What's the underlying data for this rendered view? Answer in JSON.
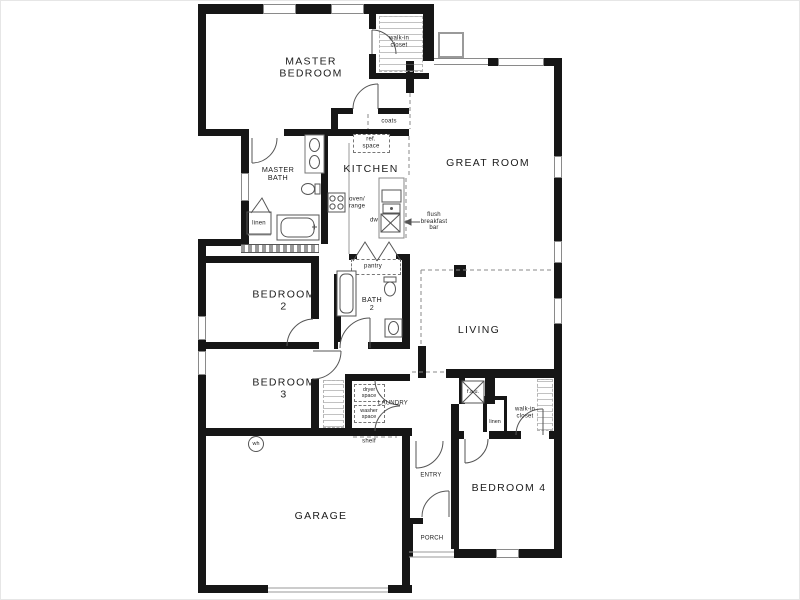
{
  "title": "Single-story house floor plan",
  "colors": {
    "wall": "#161616",
    "line": "#8a8a8a",
    "background": "#ffffff"
  },
  "labels": {
    "master_bedroom": [
      "MASTER",
      "BEDROOM"
    ],
    "walk_in_closet_master": [
      "walk-in",
      "closet"
    ],
    "coats": [
      "coats"
    ],
    "master_bath": [
      "MASTER",
      "BATH"
    ],
    "linen_master": [
      "linen"
    ],
    "ref_space": [
      "ref.",
      "space"
    ],
    "kitchen": [
      "KITCHEN"
    ],
    "oven_range": [
      "oven/",
      "range"
    ],
    "dishwasher": [
      "dw"
    ],
    "flush_breakfast_bar": [
      "flush",
      "breakfast",
      "bar"
    ],
    "great_room": [
      "GREAT ROOM"
    ],
    "pantry": [
      "pantry"
    ],
    "bedroom_2": [
      "BEDROOM",
      "2"
    ],
    "bath_2": [
      "BATH",
      "2"
    ],
    "bedroom_3": [
      "BEDROOM",
      "3"
    ],
    "dryer_space": [
      "dryer",
      "space"
    ],
    "laundry": [
      "LAUNDRY"
    ],
    "washer_space": [
      "washer",
      "space"
    ],
    "shelf": [
      "shelf"
    ],
    "water_heater": [
      "wh"
    ],
    "garage": [
      "GARAGE"
    ],
    "entry": [
      "ENTRY"
    ],
    "porch": [
      "PORCH"
    ],
    "bedroom_4": [
      "BEDROOM 4"
    ],
    "walk_in_closet_bed4": [
      "walk-in",
      "closet"
    ],
    "linen_bed4": [
      "linen"
    ],
    "fau": [
      "f.a.u."
    ],
    "living": [
      "LIVING"
    ]
  },
  "fixtures": [
    "range-burners-icon",
    "kitchen-island-sink-icon",
    "refrigerator-space-icon",
    "double-vanity-icon",
    "toilet-icon",
    "bathtub-icon",
    "linen-shelves-icon",
    "water-heater-icon",
    "fireplace-icon",
    "forced-air-unit-icon",
    "door-swing-arc-icon",
    "window-icon",
    "bifold-door-icon"
  ]
}
